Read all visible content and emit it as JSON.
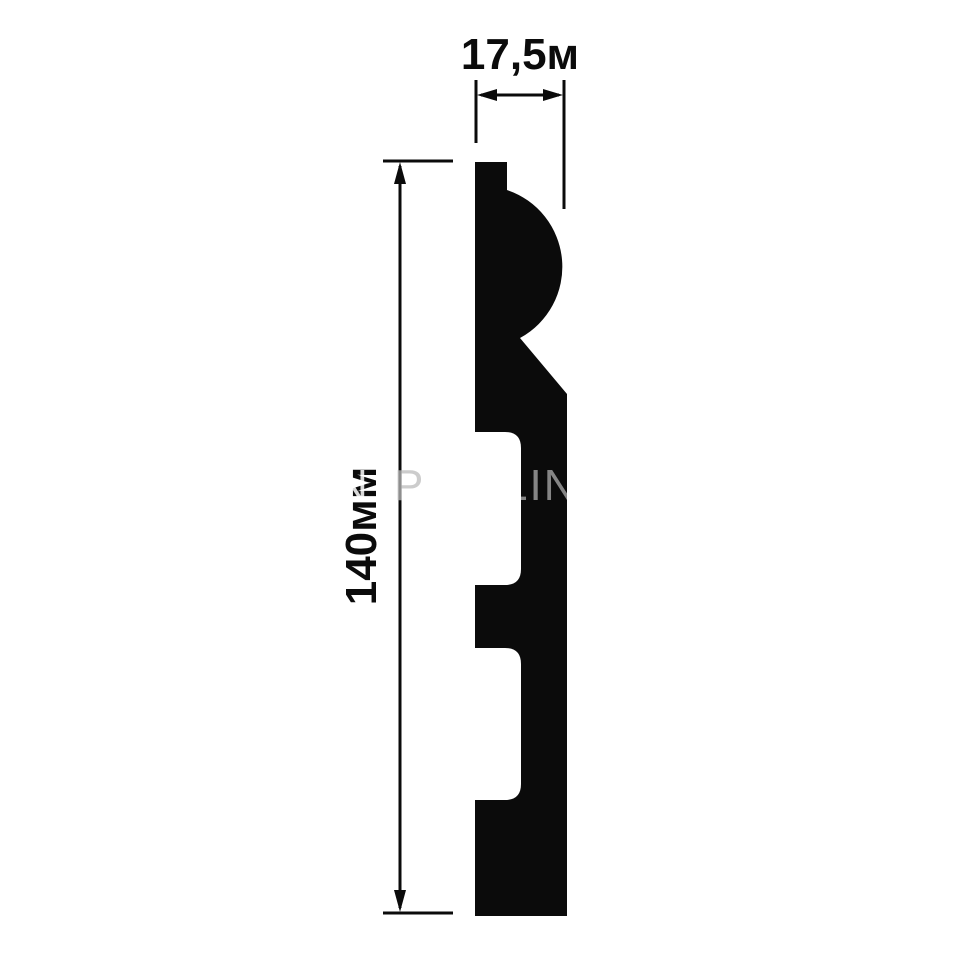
{
  "diagram": {
    "kind": "skirting-profile-cross-section",
    "background_color": "#ffffff",
    "ink_color": "#0b0b0b",
    "width_dimension": {
      "label": "17,5м",
      "value": "17,5",
      "unit": "м"
    },
    "height_dimension": {
      "label": "140мм",
      "value": "140",
      "unit": "мм"
    },
    "watermark": {
      "color_on_dark": "#7b7b7b",
      "fragments": [
        {
          "id": "left-slash",
          "text": "N"
        },
        {
          "id": "middle",
          "text": "P"
        },
        {
          "id": "on-profile",
          "text": "LIN"
        }
      ]
    }
  }
}
